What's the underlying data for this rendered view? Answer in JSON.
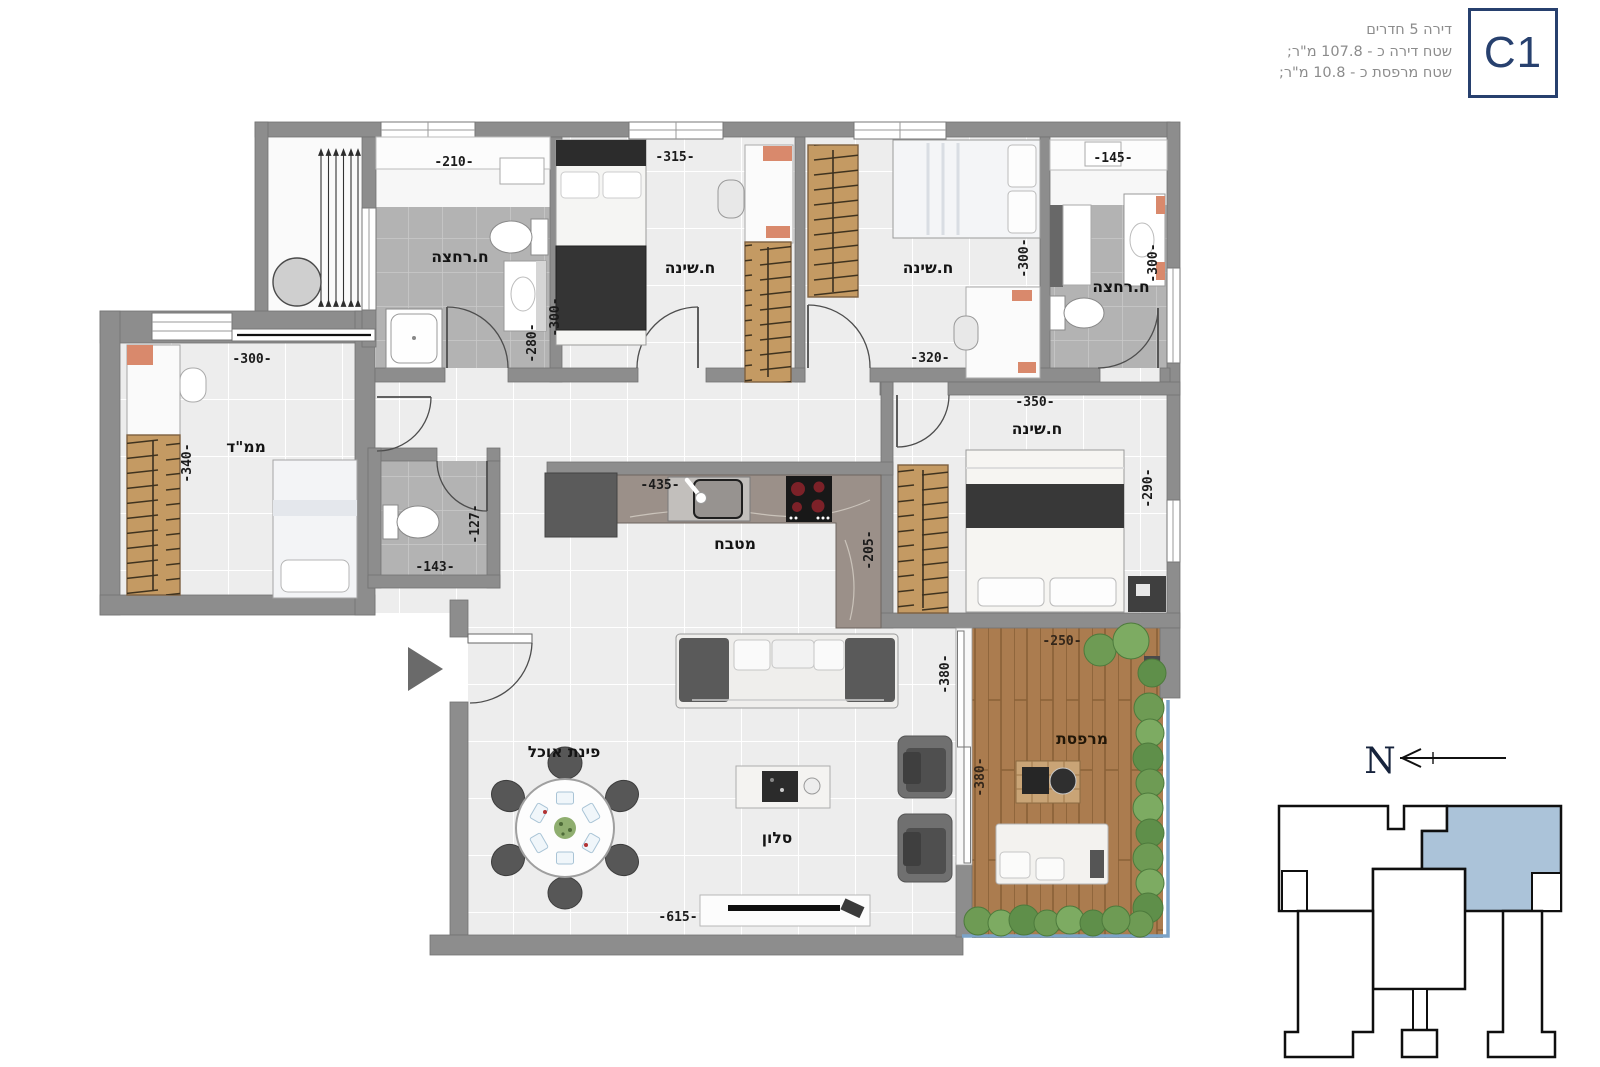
{
  "header": {
    "line1": "דירה 5 חדרים",
    "line2": "שטח דירה כ - 107.8 מ\"ר;",
    "line3": "שטח מרפסת כ - 10.8 מ\"ר;",
    "unit": "C1"
  },
  "rooms": {
    "bath1": "ח.רחצה",
    "bed1": "ח.שינה",
    "bed2": "ח.שינה",
    "bath2": "ח.רחצה",
    "mamad": "ממ\"ד",
    "kitchen": "מטבח",
    "master": "ח.שינה",
    "dining": "פינת אוכל",
    "living": "סלון",
    "balcony": "מרפסת"
  },
  "dims": {
    "bath1_w": "-210-",
    "bed1_w": "-315-",
    "bath2_w": "-145-",
    "bed1_h": "-300-",
    "bath1_h": "-280-",
    "bed2_h": "-300-",
    "bath2_h": "-300-",
    "bed2_w": "-320-",
    "master_w": "-350-",
    "mamad_w": "-300-",
    "mamad_h": "-340-",
    "wc_h": "-127-",
    "wc_w": "-143-",
    "kitchen_w": "-435-",
    "kitchen_h": "-205-",
    "master_h": "-290-",
    "living_h": "-380-",
    "balcony_h": "-380-",
    "balcony_w": "-250-",
    "living_w": "-615-"
  },
  "compass": {
    "north": "N"
  },
  "colors": {
    "accent": "#27406e",
    "keyplan_unit_fill": "#abc3d9",
    "wall": "#8d8d8d"
  }
}
